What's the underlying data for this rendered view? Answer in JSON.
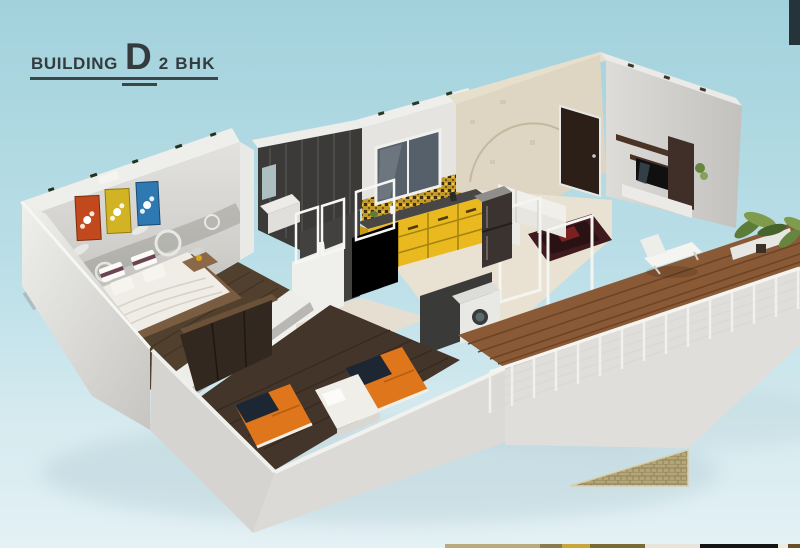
{
  "header": {
    "building_label": "BUILDING",
    "building_letter": "D",
    "unit_type": "2 BHK"
  },
  "scene": {
    "kind": "3d-isometric-cutaway-floor-plan-render",
    "rooms": [
      {
        "name": "master-bedroom",
        "features": "double bed with maroon striped pillows, grey floral mural wall, orange/yellow/blue wall art panels"
      },
      {
        "name": "bathroom",
        "features": "dark mosaic tiled walls, white vanity and fixtures"
      },
      {
        "name": "kitchen",
        "features": "yellow cabinets, dark countertop, gold mosaic backsplash, window, dark refrigerator"
      },
      {
        "name": "living-dining",
        "features": "beige arched feature wall, dark entrance door, white sofa, TV unit, maroon rug"
      },
      {
        "name": "kids-bedroom",
        "features": "two orange single beds with navy pillows, white study desk, dark wardrobe, dark wood floor"
      },
      {
        "name": "balcony",
        "features": "wood plank deck, white wire railing, white lounge chair, green plants"
      },
      {
        "name": "utility",
        "features": "white washing machine against dark tiled wall"
      }
    ]
  },
  "colors": {
    "bg_top": "#9dcfdb",
    "bg_mid": "#b9dee7",
    "bg_bottom": "#e3f1f5",
    "title_text": "#333b3e",
    "corner_block": "#25333a",
    "wall_light": "#ebebe8",
    "wall_shade": "#c9c8c4",
    "mural_grey": "#b2b1ad",
    "art_orange": "#c2491d",
    "art_yellow": "#d2b323",
    "art_blue": "#2f79b3",
    "tile_dark": "#3b3a38",
    "cabinet_yellow": "#e9b91f",
    "counter_dark": "#494745",
    "backsplash_gold": "#c3992b",
    "floor_cream": "#e9e2d3",
    "floor_wood_dark": "#44352a",
    "bed_orange": "#e0761b",
    "pillow_navy": "#1d2733",
    "deck_brown": "#8a5a36",
    "railing_white": "#f0f0ec",
    "door_brown": "#2b1f18",
    "feature_beige": "#ded6c2",
    "sofa_white": "#f0efeb",
    "tv_unit_brown": "#4a3426",
    "rug_maroon": "#401a1e",
    "plant_green": "#66853f",
    "brick_tan": "#b5a678",
    "strip": [
      "#b9a97e",
      "#8a7a50",
      "#caa53b",
      "#7a6a35",
      "#e8e4da",
      "#151515",
      "#efeae2",
      "#6a4e28"
    ]
  }
}
